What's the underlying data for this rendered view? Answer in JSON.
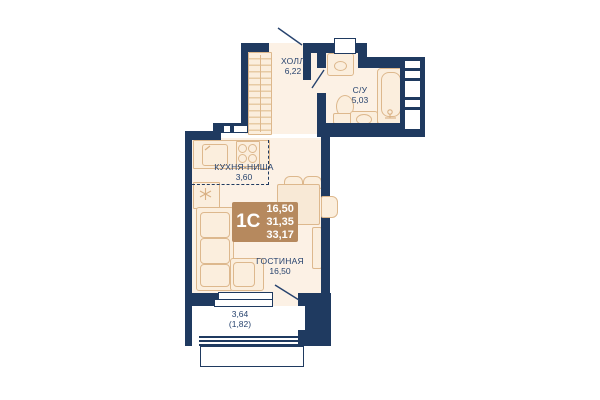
{
  "unit": {
    "label": "1С",
    "area_living": "16,50",
    "area_total": "31,35",
    "area_full": "33,17"
  },
  "rooms": {
    "hall": {
      "name": "ХОЛЛ",
      "area": "6,22"
    },
    "bathroom": {
      "name": "С/У",
      "area": "5,03"
    },
    "kitchen": {
      "name": "КУХНЯ-НИША",
      "area": "3,60"
    },
    "living": {
      "name": "ГОСТИНАЯ",
      "area": "16,50"
    },
    "balcony": {
      "area": "3,64",
      "area_secondary": "(1,82)"
    }
  },
  "icons": [
    "wardrobe-icon",
    "fridge-icon",
    "kitchen-sink-icon",
    "stove-icon",
    "sofa-icon",
    "dining-table-icon",
    "chair-icon",
    "tv-unit-icon",
    "toilet-icon",
    "washbasin-icon",
    "bathtub-icon",
    "washing-machine-icon",
    "window",
    "balcony-glazing",
    "door-swing-line",
    "vent-shaft"
  ],
  "colors": {
    "wall": "#1f3a60",
    "floor": "#fcf1e5",
    "furnfill": "#fbeedd",
    "tan": "#ddb88d",
    "tan2": "#e7cba4",
    "box": "#b6895e",
    "text": "#27436e"
  }
}
